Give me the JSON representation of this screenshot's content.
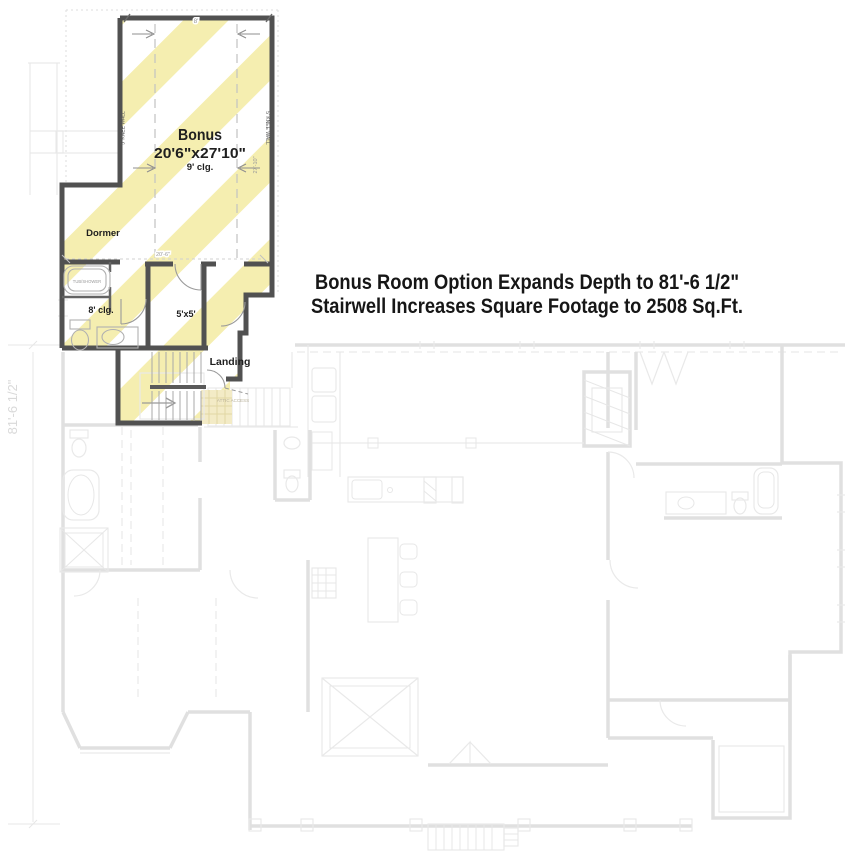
{
  "colors": {
    "stripe": "#f5eeb0",
    "wall": "#515151",
    "faded": "#e0e0e0",
    "faded-light": "#e9e9e9",
    "label": "#1f1f1f",
    "dim": "#9a9a9a",
    "dim-faint": "#d9d9d9",
    "dash": "#c2c2c2",
    "attic-fill": "#f3ebc6",
    "attic-line": "#e2d7a4",
    "attic-text": "#b9b29a"
  },
  "caption": {
    "line1": "Bonus Room Option Expands Depth to 81'-6 1/2\"",
    "line2": "Stairwell Increases Square Footage to 2508 Sq.Ft."
  },
  "bonus_plan": {
    "room_label": "Bonus",
    "room_dimensions": "20'6\"x27'10\"",
    "room_ceiling": "9' clg.",
    "knee_wall_left": "5' KNEE WALL",
    "knee_wall_right": "5' KNEE WALL",
    "dormer_label": "Dormer",
    "tub_label": "TUB/SHOWER",
    "bath_ceiling": "8' clg.",
    "closet_label": "5'x5'",
    "landing_label": "Landing",
    "attic_label": "ATTIC ACCESS",
    "dim_top": "8'",
    "dim_width": "20'-6\"",
    "dim_depth": "27'-10\"",
    "dim_overall_depth": "81'-6 1/2\""
  }
}
